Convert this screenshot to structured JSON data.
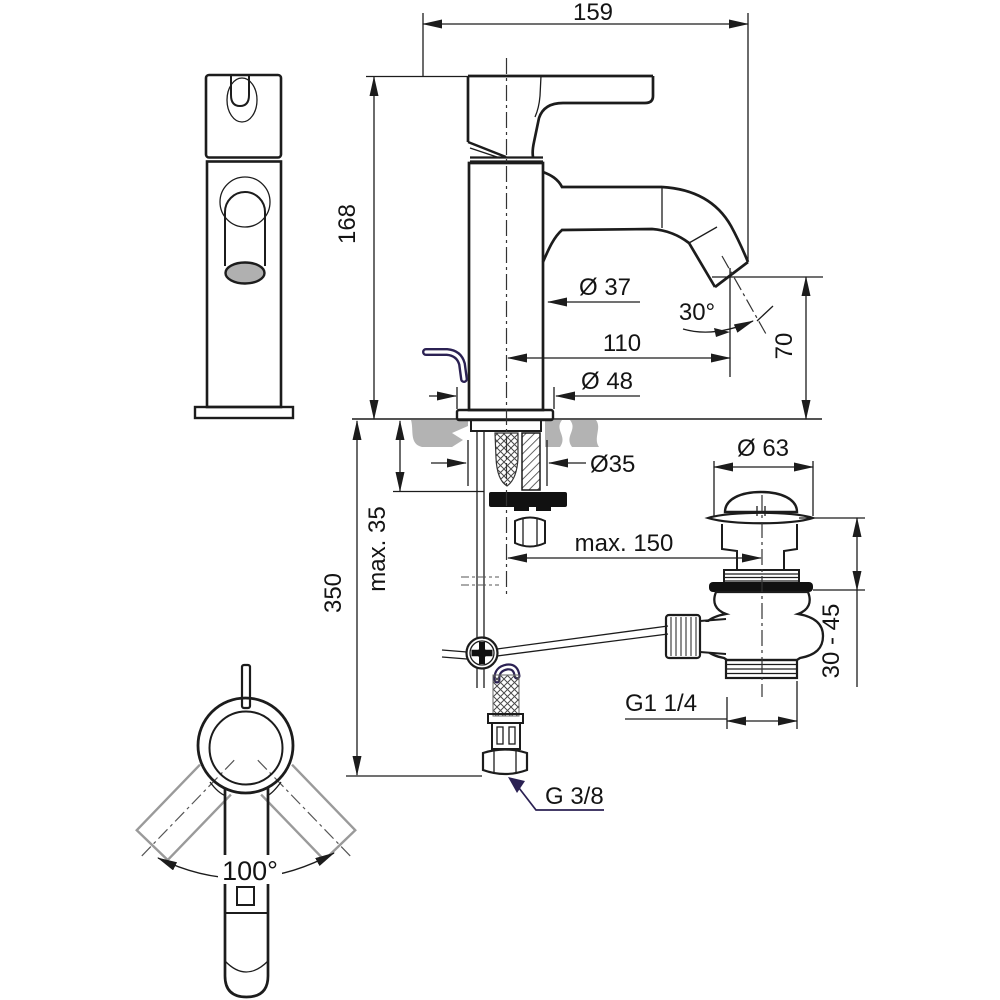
{
  "drawing": {
    "title": "Single-lever basin mixer with pop-up waste — dimension drawing",
    "dims": {
      "total_length": "159",
      "body_height": "168",
      "body_diameter": "Ø 37",
      "spout_angle": "30°",
      "spout_reach": "110",
      "outlet_height": "70",
      "base_diameter": "Ø 48",
      "mounting_hole": "Ø35",
      "max_deck_thickness": "max. 35",
      "supply_height": "350",
      "waste_offset": "max. 150",
      "waste_cap_diameter": "Ø 63",
      "waste_clamp_range": "30 - 45",
      "waste_thread": "G1 1/4",
      "supply_thread": "G 3/8",
      "swivel_angle": "100°"
    },
    "colors": {
      "line": "#1c1c1c",
      "hose_accent": "#2b2153",
      "counter_gray": "#b3b3b3",
      "outlet_gray": "#b0b0b0",
      "ghost_gray": "#9a9a9a"
    }
  }
}
